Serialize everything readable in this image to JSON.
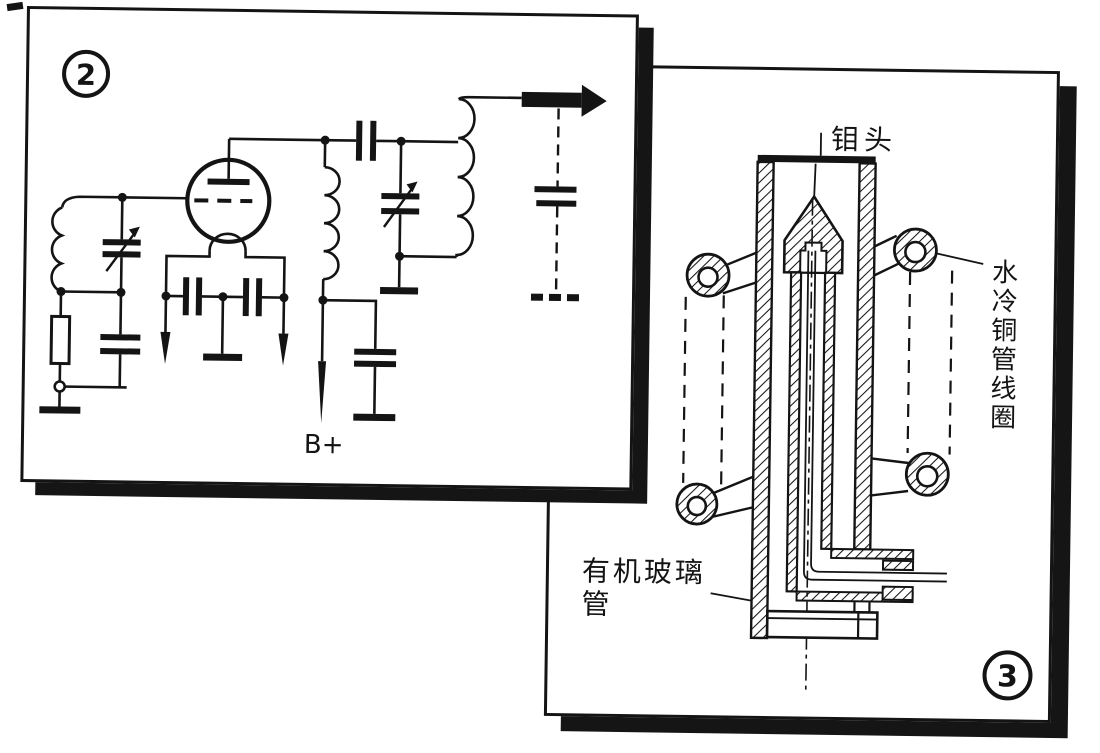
{
  "figure2": {
    "badge": "2",
    "supply_label": "B+"
  },
  "figure3": {
    "badge": "3",
    "tip_label": "钼头",
    "coil_label": "水冷铜管线圈",
    "coil_label_chars": [
      "水",
      "冷",
      "铜",
      "管",
      "线",
      "圈"
    ],
    "tube_label_line1": "有机玻璃",
    "tube_label_line2": "管"
  },
  "colors": {
    "ink": "#141414",
    "paper": "#ffffff"
  }
}
